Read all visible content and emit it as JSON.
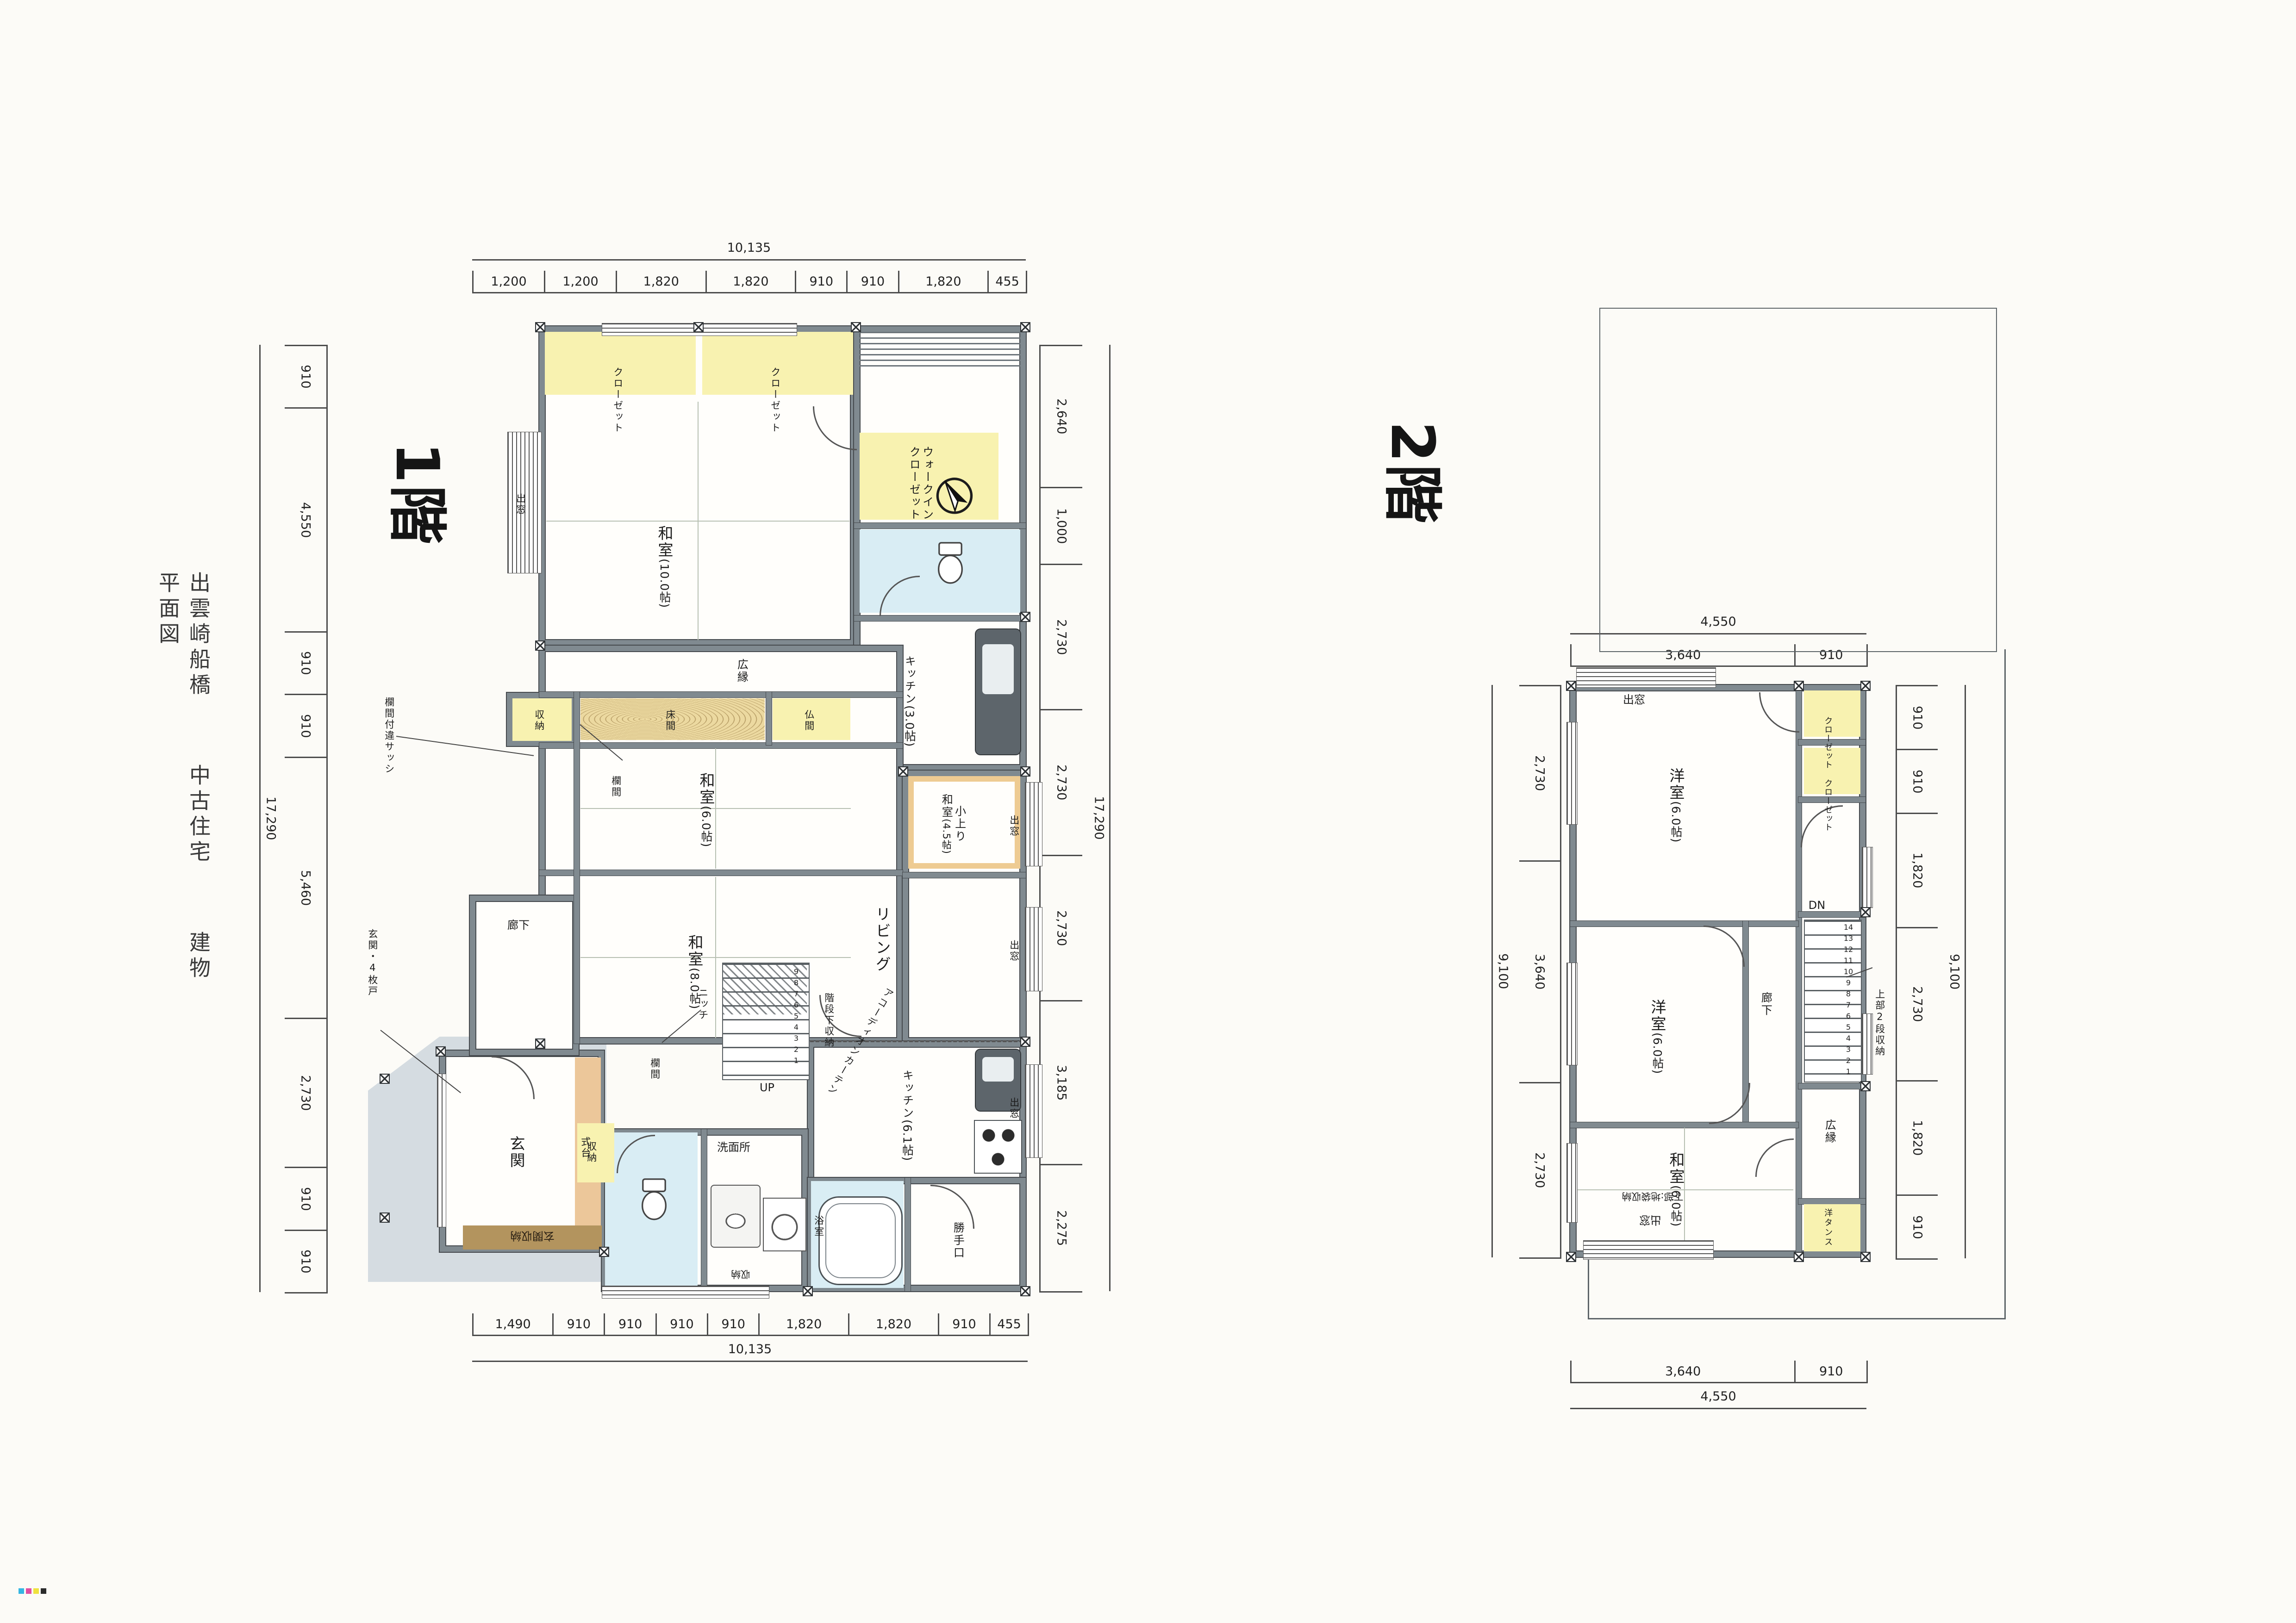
{
  "title": {
    "part1": "出雲崎船橋",
    "part2": "中古住宅",
    "part3": "建物平面図"
  },
  "f1": {
    "floor_label": "1階",
    "dims": {
      "top_total": "10,135",
      "top": [
        "1,200",
        "1,200",
        "1,820",
        "1,820",
        "910",
        "910",
        "1,820",
        "455"
      ],
      "bottom": [
        "1,490",
        "910",
        "910",
        "910",
        "910",
        "1,820",
        "1,820",
        "910",
        "455"
      ],
      "bottom_total": "10,135",
      "left": [
        "910",
        "4,550",
        "910",
        "910",
        "5,460",
        "2,730",
        "910",
        "910"
      ],
      "left_total": "17,290",
      "right": [
        "2,640",
        "1,000",
        "2,730",
        "2,730",
        "2,730",
        "3,185",
        "2,275"
      ],
      "right_total": "17,290"
    },
    "rooms": {
      "closet1": "クローゼット",
      "closet2": "クローゼット",
      "wic": "ウォークイン\nクローゼット",
      "washitsu10": "和室",
      "washitsu10_size": "(10.0帖)",
      "demado_left": "出窓",
      "kitchen3": "キッチン",
      "kitchen3_size": "(3.0帖)",
      "hiroen": "広縁",
      "shuno": "収納",
      "tokonoma": "床間",
      "butsuma": "仏間",
      "washitsu6": "和室",
      "washitsu6_size": "(6.0帖)",
      "ranma": "欄間",
      "koagari": "小上り\n和室",
      "koagari_size": "(4.5帖)",
      "living": "リビング",
      "demado_right": "出窓",
      "washitsu8": "和室",
      "washitsu8_size": "(8.0帖)",
      "rouka": "廊下",
      "nicchi": "ニッチ",
      "kaidan_shita": "階段下収納",
      "accordion": "アコーディオンカーテン",
      "kitchen6": "キッチン",
      "kitchen6_size": "(6.1帖)",
      "demado_kitchen": "出窓",
      "katteguchi": "勝手口",
      "senmenjo": "洗面所",
      "yokushitsu": "浴室",
      "shuno_wc": "収納",
      "shuno_small": "収納",
      "genkan": "玄関",
      "shikidai": "式台",
      "genkan_shuno": "玄関収納",
      "note_genkan": "玄関・4枚戸",
      "note_sash": "欄間付違サッシ",
      "up": "UP",
      "stair_nums": [
        "9",
        "8",
        "7",
        "6",
        "5",
        "4",
        "3",
        "2",
        "1"
      ]
    }
  },
  "f2": {
    "floor_label": "2階",
    "dims": {
      "top_total": "4,550",
      "top": [
        "3,640",
        "910"
      ],
      "bottom": [
        "3,640",
        "910"
      ],
      "bottom_total": "4,550",
      "left": [
        "2,730",
        "3,640",
        "2,730"
      ],
      "left_total": "9,100",
      "right": [
        "910",
        "910",
        "1,820",
        "2,730",
        "1,820",
        "910"
      ],
      "right_total": "9,100"
    },
    "rooms": {
      "demado_top": "出窓",
      "yoshitsu_a": "洋室",
      "yoshitsu_a_size": "(6.0帖)",
      "closet_a": "クローゼット",
      "closet_b": "クローゼット",
      "yoshitsu_b": "洋室",
      "yoshitsu_b_size": "(6.0帖)",
      "rouka": "廊下",
      "dn": "DN",
      "stair_nums": [
        "14",
        "13",
        "12",
        "11",
        "10",
        "9",
        "8",
        "7",
        "6",
        "5",
        "4",
        "3",
        "2",
        "1"
      ],
      "jobu": "上部2段収納",
      "washitsu6": "和室",
      "washitsu6_size": "(6.0帖)",
      "hiroen": "広縁",
      "yotansu": "洋タンス",
      "demado_btm": "出窓",
      "kabu": "下部:地袋収納"
    }
  },
  "marks": {
    "colors": [
      "#35b6e3",
      "#e04fa2",
      "#efe23e",
      "#2b2b2b"
    ]
  }
}
